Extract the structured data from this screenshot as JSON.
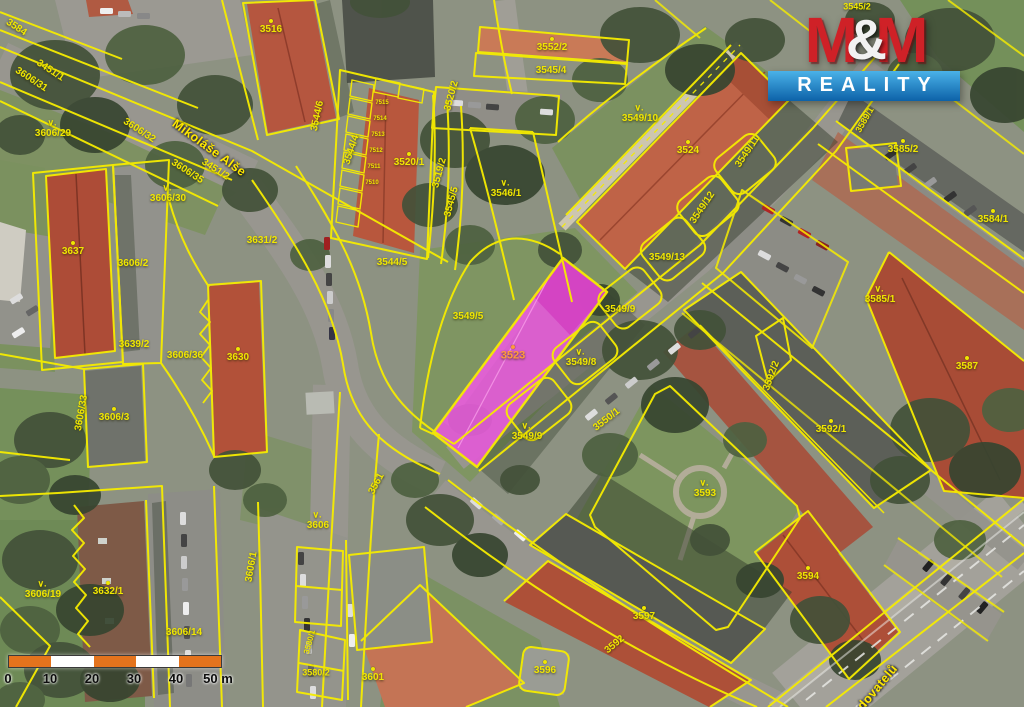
{
  "map": {
    "line_color": "#f6ec00",
    "label_color": "#f0e602",
    "highlighted_parcel": {
      "number": "3523",
      "fill": "#e25ad6",
      "label_color": "#ff9a3c"
    },
    "labels": [
      {
        "t": "3584",
        "x": 16,
        "y": 28,
        "r": 33
      },
      {
        "t": "3606/31",
        "x": 31,
        "y": 80,
        "r": 33
      },
      {
        "t": "3451/1",
        "x": 50,
        "y": 71,
        "r": 33
      },
      {
        "t": "3606/29",
        "x": 53,
        "y": 134,
        "mark": true
      },
      {
        "t": "3606/32",
        "x": 139,
        "y": 131,
        "r": 33
      },
      {
        "t": "Mikoláše Alše",
        "x": 209,
        "y": 148,
        "r": 36,
        "street": true
      },
      {
        "t": "3606/35",
        "x": 187,
        "y": 172,
        "r": 33
      },
      {
        "t": "3451/2",
        "x": 215,
        "y": 170,
        "r": 33
      },
      {
        "t": "3606/30",
        "x": 168,
        "y": 199,
        "mark": true
      },
      {
        "t": "3516",
        "x": 271,
        "y": 30,
        "dot": true
      },
      {
        "t": "3544/6",
        "x": 318,
        "y": 116,
        "r": -78
      },
      {
        "t": "3544/4",
        "x": 352,
        "y": 150,
        "r": -72
      },
      {
        "t": "3520/1",
        "x": 409,
        "y": 163,
        "dot": true
      },
      {
        "t": "3520/2",
        "x": 452,
        "y": 96,
        "r": -75
      },
      {
        "t": "3519/2",
        "x": 440,
        "y": 173,
        "r": -75
      },
      {
        "t": "3545/5",
        "x": 452,
        "y": 202,
        "r": -75
      },
      {
        "t": "3546/1",
        "x": 506,
        "y": 194,
        "mark": true
      },
      {
        "t": "3544/5",
        "x": 392,
        "y": 263
      },
      {
        "t": "3631/2",
        "x": 262,
        "y": 241
      },
      {
        "t": "3552/2",
        "x": 552,
        "y": 48,
        "dot": true
      },
      {
        "t": "3545/4",
        "x": 551,
        "y": 71
      },
      {
        "t": "3545/2",
        "x": 857,
        "y": 7,
        "s": 9
      },
      {
        "t": "3549/10",
        "x": 640,
        "y": 119,
        "mark": true
      },
      {
        "t": "3524",
        "x": 688,
        "y": 151,
        "dot": true
      },
      {
        "t": "3549/11",
        "x": 748,
        "y": 152,
        "r": -56
      },
      {
        "t": "3549/12",
        "x": 703,
        "y": 208,
        "r": -56
      },
      {
        "t": "3549/13",
        "x": 667,
        "y": 258
      },
      {
        "t": "3549/5",
        "x": 468,
        "y": 317
      },
      {
        "t": "3549/9",
        "x": 620,
        "y": 310
      },
      {
        "t": "3523",
        "x": 513,
        "y": 356,
        "c": "#ff9a3c",
        "dot": true,
        "s": 11
      },
      {
        "t": "3549/8",
        "x": 581,
        "y": 363,
        "mark": true
      },
      {
        "t": "3549/9",
        "x": 527,
        "y": 437,
        "mark": true
      },
      {
        "t": "3550/1",
        "x": 607,
        "y": 420,
        "r": -38
      },
      {
        "t": "3561",
        "x": 377,
        "y": 484,
        "r": -62
      },
      {
        "t": "3606",
        "x": 318,
        "y": 526,
        "mark": true
      },
      {
        "t": "3637",
        "x": 73,
        "y": 252,
        "dot": true
      },
      {
        "t": "3606/2",
        "x": 133,
        "y": 264
      },
      {
        "t": "3639/2",
        "x": 134,
        "y": 345
      },
      {
        "t": "3606/36",
        "x": 185,
        "y": 356
      },
      {
        "t": "3630",
        "x": 238,
        "y": 358,
        "dot": true
      },
      {
        "t": "3606/33",
        "x": 82,
        "y": 413,
        "r": -80
      },
      {
        "t": "3606/3",
        "x": 114,
        "y": 418,
        "dot": true
      },
      {
        "t": "3606/19",
        "x": 43,
        "y": 595,
        "mark": true
      },
      {
        "t": "3632/1",
        "x": 108,
        "y": 592,
        "dot": true
      },
      {
        "t": "3606/14",
        "x": 184,
        "y": 633
      },
      {
        "t": "3606/1",
        "x": 252,
        "y": 567,
        "r": -80
      },
      {
        "t": "3580/1",
        "x": 310,
        "y": 642,
        "r": -75,
        "s": 8
      },
      {
        "t": "3580/2",
        "x": 316,
        "y": 673,
        "s": 9
      },
      {
        "t": "3601",
        "x": 373,
        "y": 678,
        "dot": true
      },
      {
        "t": "3596",
        "x": 545,
        "y": 671,
        "dot": true
      },
      {
        "t": "3592",
        "x": 615,
        "y": 645,
        "r": -40
      },
      {
        "t": "3597",
        "x": 644,
        "y": 617,
        "dot": true
      },
      {
        "t": "3593",
        "x": 705,
        "y": 494,
        "mark": true
      },
      {
        "t": "3594",
        "x": 808,
        "y": 577,
        "dot": true
      },
      {
        "t": "3592/1",
        "x": 831,
        "y": 430,
        "dot": true
      },
      {
        "t": "3592/2",
        "x": 772,
        "y": 376,
        "r": -70
      },
      {
        "t": "3585/1",
        "x": 880,
        "y": 300,
        "mark": true
      },
      {
        "t": "3587",
        "x": 967,
        "y": 367,
        "dot": true
      },
      {
        "t": "3584/1",
        "x": 993,
        "y": 220,
        "dot": true
      },
      {
        "t": "3585/2",
        "x": 903,
        "y": 150,
        "dot": true
      },
      {
        "t": "3589/1",
        "x": 865,
        "y": 120,
        "r": -60,
        "s": 9
      },
      {
        "t": "Budovatelů",
        "x": 872,
        "y": 694,
        "r": -50,
        "street": true
      },
      {
        "t": "7515",
        "x": 382,
        "y": 103,
        "s": 6
      },
      {
        "t": "7514",
        "x": 380,
        "y": 119,
        "s": 6
      },
      {
        "t": "7513",
        "x": 378,
        "y": 135,
        "s": 6
      },
      {
        "t": "7512",
        "x": 376,
        "y": 151,
        "s": 6
      },
      {
        "t": "7511",
        "x": 374,
        "y": 167,
        "s": 6
      },
      {
        "t": "7510",
        "x": 372,
        "y": 183,
        "s": 6
      }
    ]
  },
  "logo": {
    "m1": "M",
    "amp": "&",
    "m2": "M",
    "reality": "REALITY",
    "red": "#cf2127",
    "blue_top": "#4ab2e8",
    "blue_bottom": "#0d62a8"
  },
  "scalebar": {
    "ticks": [
      "0",
      "10",
      "20",
      "30",
      "40",
      "50 m"
    ],
    "segments": [
      "#e4731d",
      "#ffffff",
      "#e4731d",
      "#ffffff",
      "#e4731d"
    ]
  }
}
